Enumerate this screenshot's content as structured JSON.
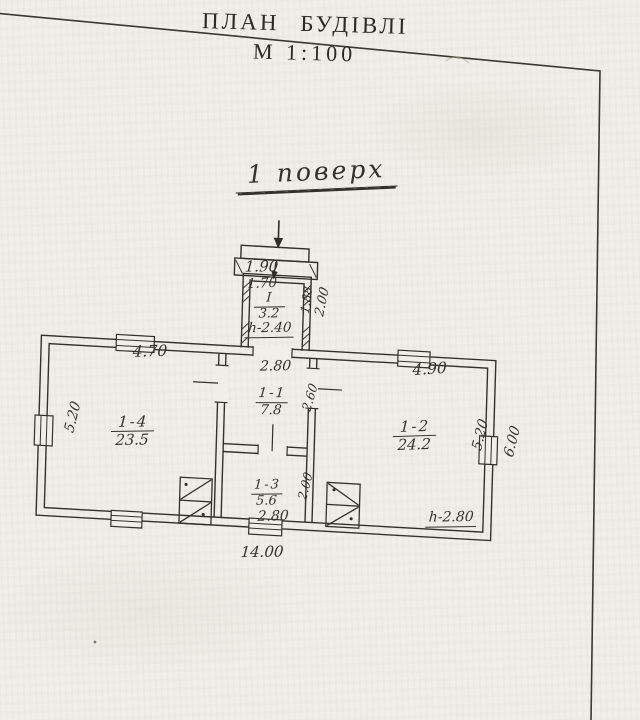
{
  "colors": {
    "paper": "#efeee8",
    "ink": "#33312c"
  },
  "title": {
    "line1": "ПЛАН БУДІВЛІ",
    "line2": "М 1:100"
  },
  "floor_label": "1 поверх",
  "plan": {
    "entrance_steps": {
      "outer_width": "1.90",
      "inner_width": "1.70"
    },
    "porch": {
      "no": "I",
      "area": "3.2",
      "ceiling_height": "h-2.40",
      "depth_inner": "1.88",
      "depth_outer": "2.00"
    },
    "rooms": [
      {
        "no": "1-4",
        "area": "23.5",
        "width": "4.70",
        "depth": "5.20"
      },
      {
        "no": "1-1",
        "area": "7.8",
        "width": "2.80",
        "depth": "2.60"
      },
      {
        "no": "1-2",
        "area": "24.2",
        "width": "4.90",
        "depth": "5.20",
        "ceiling_height": "h-2.80"
      },
      {
        "no": "1-3",
        "area": "5.6",
        "width": "2.80",
        "depth": "2.00"
      }
    ],
    "overall": {
      "width": "14.00",
      "right_depth": "6.00"
    }
  }
}
